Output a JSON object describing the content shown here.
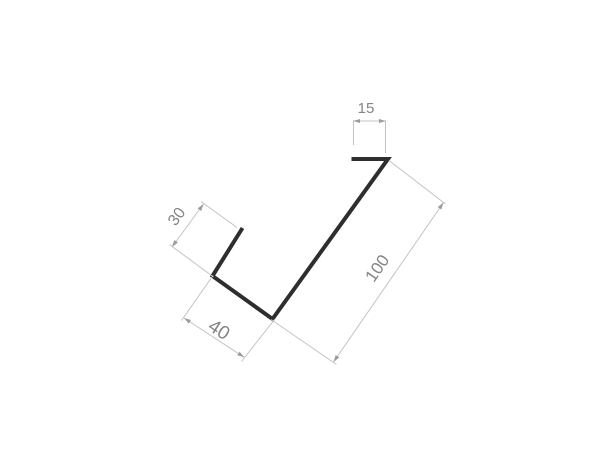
{
  "page": {
    "background_color": "#ffffff"
  },
  "drawing": {
    "profile": {
      "stroke_color": "#2e2e2e"
    },
    "dimension_style": {
      "line_color": "#c3c3c3",
      "arrow_color": "#9c9c9c",
      "text_color": "#848484"
    },
    "dimensions": {
      "hem_width": {
        "label": "15"
      },
      "upstand_height": {
        "label": "30"
      },
      "face_length": {
        "label": "100"
      },
      "bottom_width": {
        "label": "40"
      }
    }
  }
}
